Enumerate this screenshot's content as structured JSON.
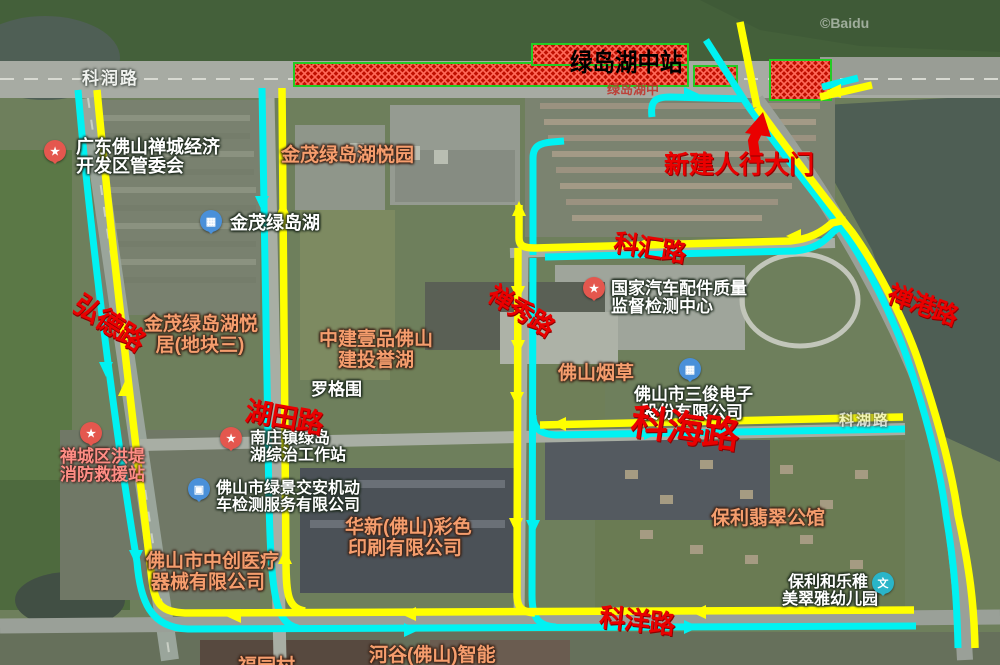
{
  "map": {
    "watermark": "©Baidu"
  },
  "colors": {
    "route_yellow": "#ffff00",
    "route_cyan": "#00f2f2",
    "station_fill": "#bf0f00",
    "station_border": "#24cb24",
    "annotation_red": "#ea0000"
  },
  "annotations": {
    "station_label": "绿岛湖中站",
    "gate_label": "新建人行大门",
    "roads": {
      "hongde": "弘德路",
      "hutian": "湖田路",
      "chanxiu": "禅秀路",
      "kehui": "科汇路",
      "changang": "禅港路",
      "kehai": "科海路",
      "keyang": "科洋路"
    }
  },
  "base_labels": {
    "kerun_road": "科润路",
    "kehu_road": "科湖路",
    "station_base": "绿岛湖中",
    "luogewei": "罗格围",
    "hegu": "河谷(佛山)智能",
    "fuyuan": "福园村"
  },
  "pin_glyphs": {
    "star": "★",
    "building": "▦",
    "car": "▣",
    "school": "文"
  },
  "pois": {
    "guanweihui": {
      "line1": "广东佛山禅城经济",
      "line2": "开发区管委会"
    },
    "jinmao_yueyuan": {
      "line1": "金茂绿岛湖悦园"
    },
    "jinmao_lake": {
      "line1": "金茂绿岛湖"
    },
    "jinmao_yueju": {
      "line1": "金茂绿岛湖悦",
      "line2": "居(地块三)"
    },
    "zhongjian": {
      "line1": "中建壹品佛山",
      "line2": "建投誉湖"
    },
    "guojia": {
      "line1": "国家汽车配件质量",
      "line2": "监督检测中心"
    },
    "yancao": {
      "line1": "佛山烟草"
    },
    "sanjun": {
      "line1": "佛山市三俊电子",
      "line2": "股份有限公司"
    },
    "xiaofang": {
      "line1": "禅城区洪堤",
      "line2": "消防救援站"
    },
    "zongzhi": {
      "line1": "南庄镇绿岛",
      "line2": "湖综治工作站"
    },
    "lvjing": {
      "line1": "佛山市绿景交安机动",
      "line2": "车检测服务有限公司"
    },
    "zhongchuang": {
      "line1": "佛山市中创医疗",
      "line2": "器械有限公司"
    },
    "huaxin": {
      "line1": "华新(佛山)彩色",
      "line2": "印刷有限公司"
    },
    "baoli_mansion": {
      "line1": "保利翡翠公馆"
    },
    "baoli_kindergarten": {
      "line1": "保利和乐稚",
      "line2": "美翠雅幼儿园"
    }
  }
}
